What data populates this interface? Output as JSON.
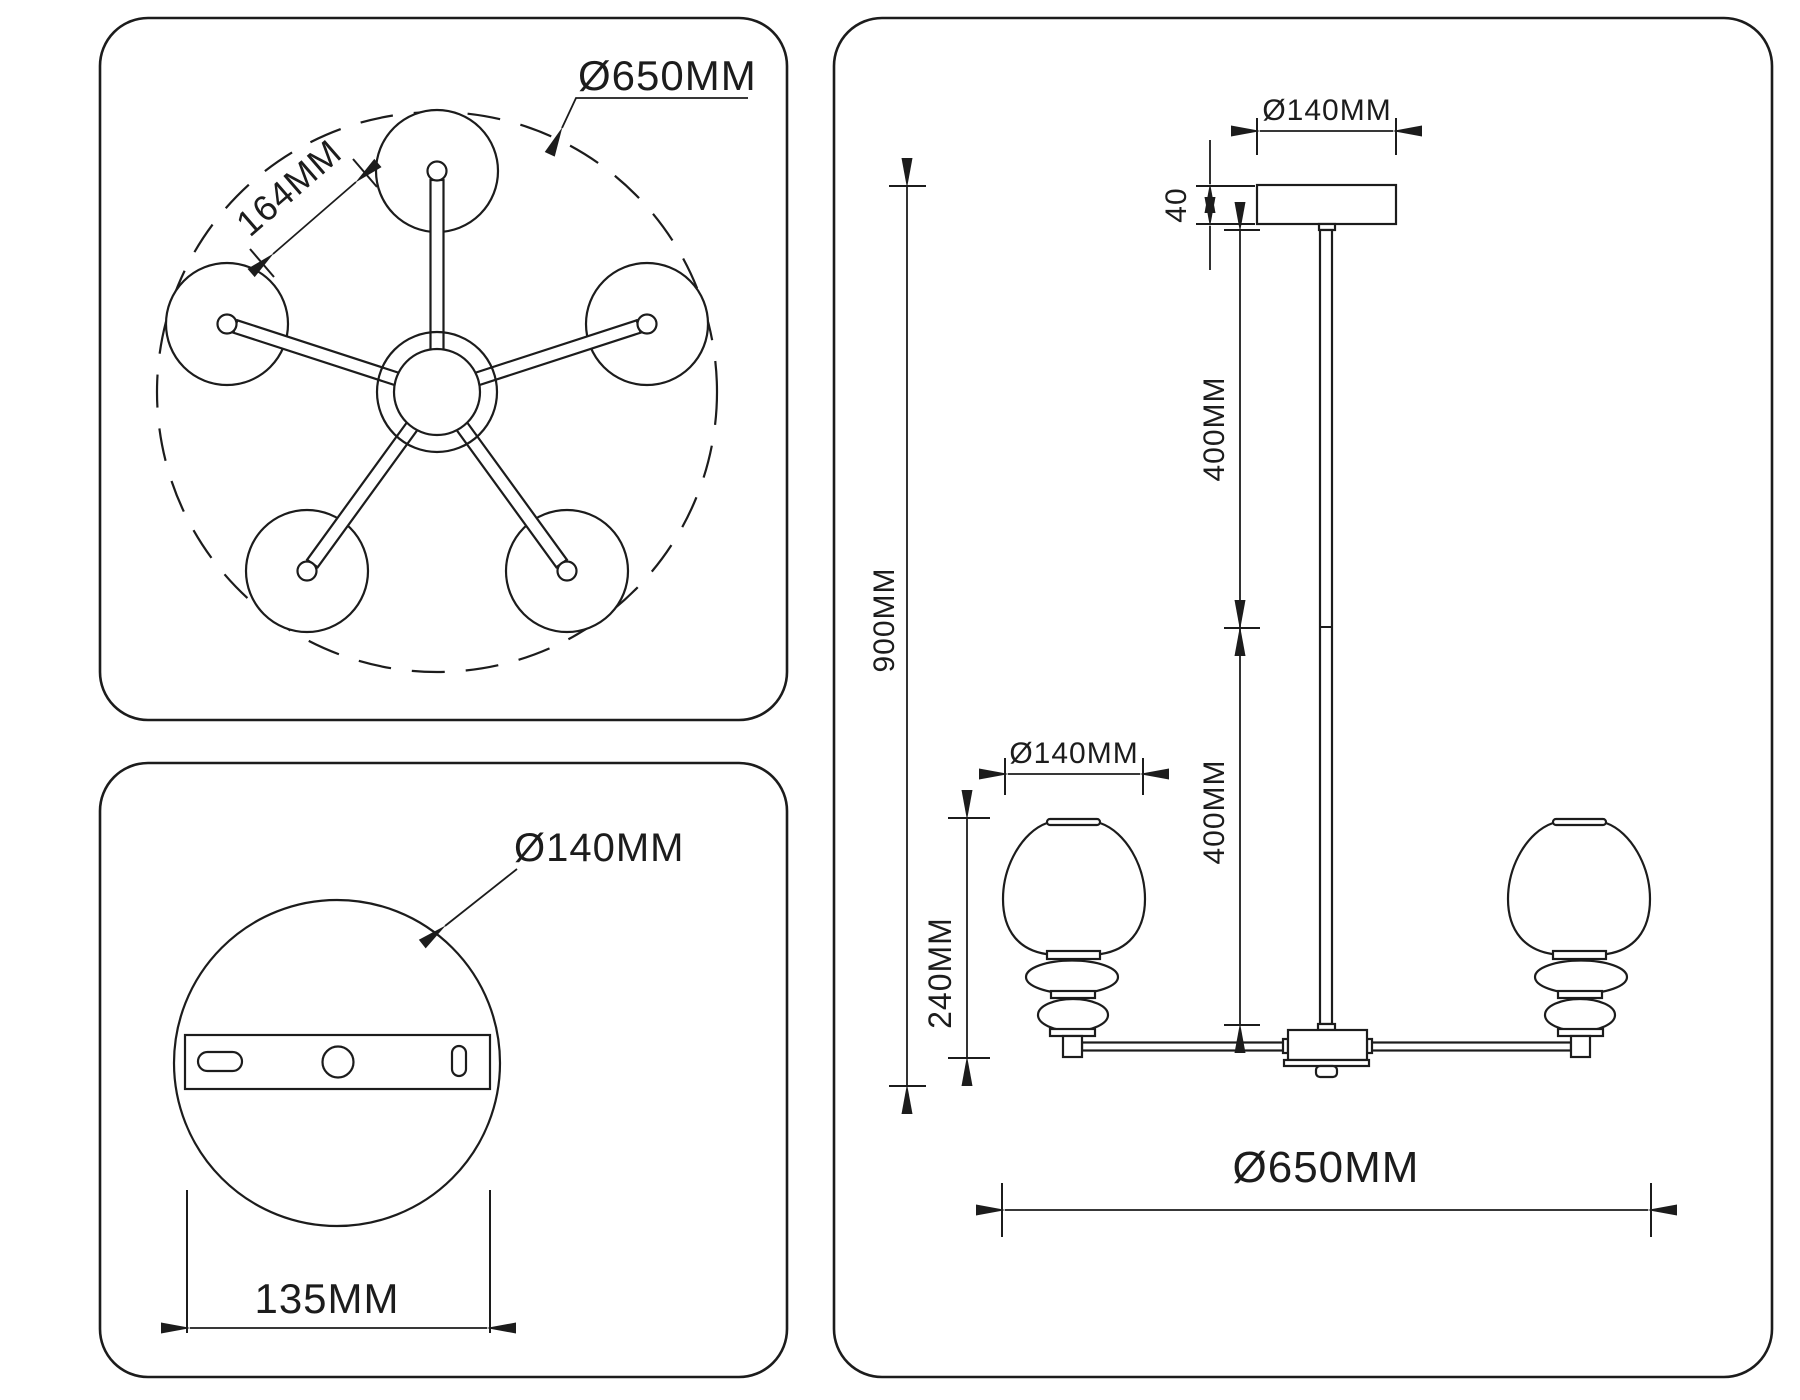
{
  "drawing": {
    "line_color": "#1c1c1c",
    "background": "#ffffff",
    "top_view": {
      "overall_diameter_label": "Ø650MM",
      "shade_gap_label": "164MM"
    },
    "bottom_view": {
      "canopy_diameter_label": "Ø140MM",
      "bracket_width_label": "135MM"
    },
    "side_view": {
      "canopy_diameter_label": "Ø140MM",
      "canopy_height_label": "40",
      "upper_rod_label": "400MM",
      "lower_rod_label": "400MM",
      "overall_height_label": "900MM",
      "shade_diameter_label": "Ø140MM",
      "shade_height_label": "240MM",
      "overall_width_label": "Ø650MM"
    }
  }
}
